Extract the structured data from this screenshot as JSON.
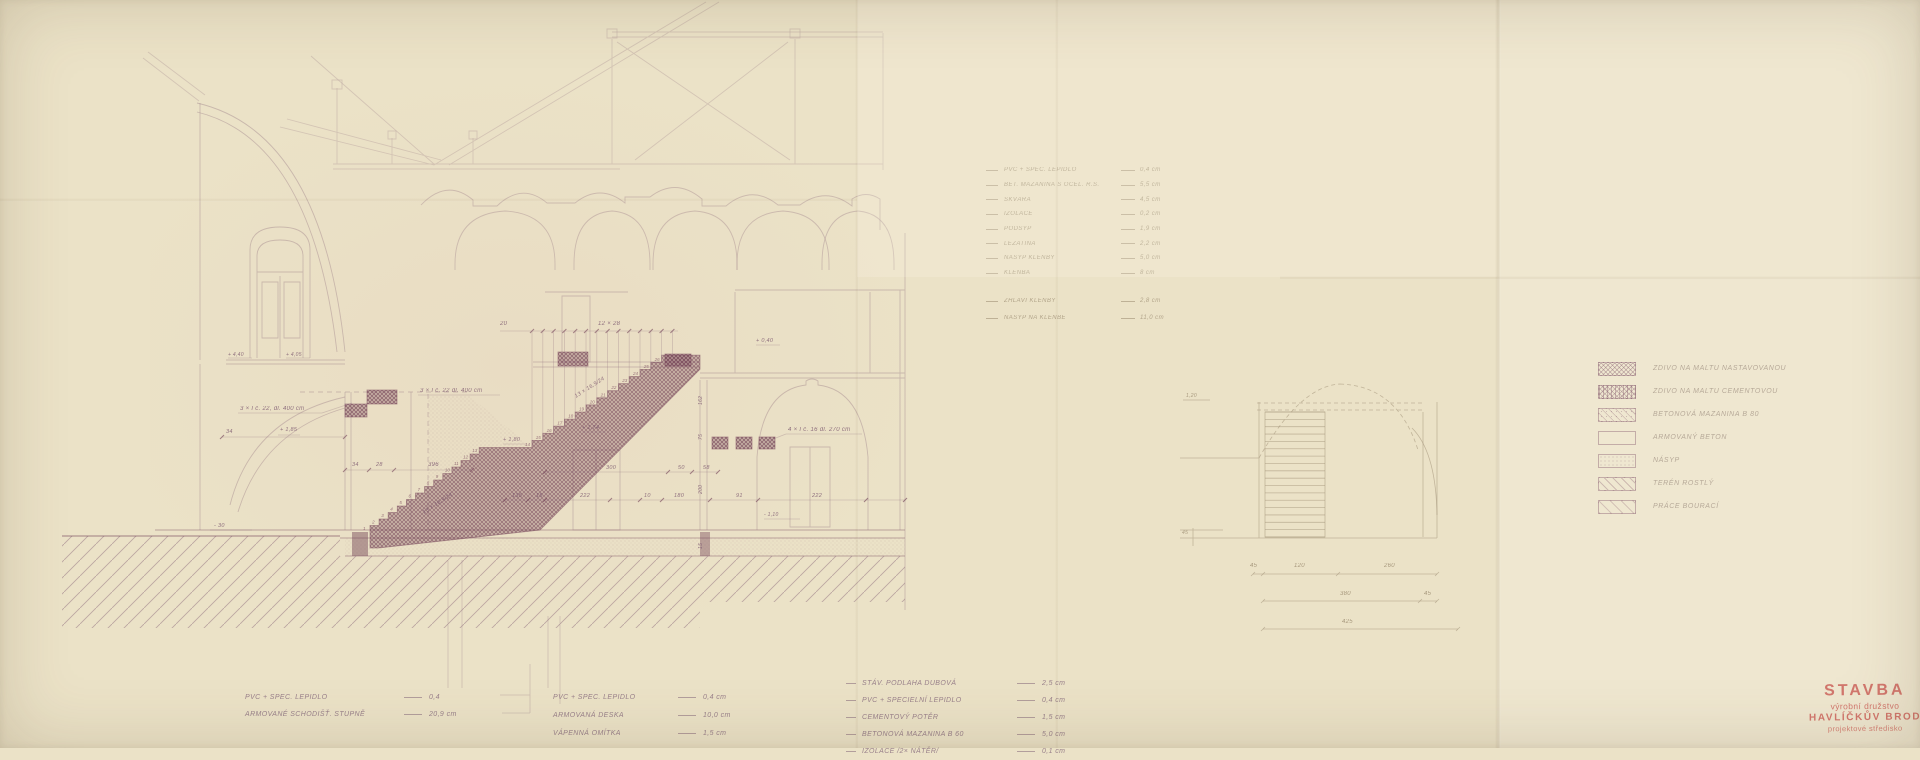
{
  "colors": {
    "paper": "#ebe2c7",
    "ink": "#8d6c7c",
    "ink_dark": "#6d3b52",
    "pencil": "#a5967c",
    "stamp_red": "#c3473e"
  },
  "stamp": {
    "line1": "STAVBA",
    "line2": "výrobní družstvo",
    "line3": "HAVLÍČKŮV BROD",
    "line4": "projektové středisko"
  },
  "legend": {
    "items": [
      {
        "pattern": "cross1",
        "label": "ZDIVO NA MALTU NASTAVOVANOU"
      },
      {
        "pattern": "cross2",
        "label": "ZDIVO NA MALTU CEMENTOVOU"
      },
      {
        "pattern": "diagdots",
        "label": "BETONOVÁ MAZANINA B 80"
      },
      {
        "pattern": "empty",
        "label": "ARMOVANÝ BETON"
      },
      {
        "pattern": "dots",
        "label": "NÁSYP"
      },
      {
        "pattern": "diag",
        "label": "TERÉN ROSTLÝ"
      },
      {
        "pattern": "diag2",
        "label": "PRÁCE BOURACÍ"
      }
    ]
  },
  "spec_list": {
    "rows": [
      {
        "label": "PVC + SPEC. LEPIDLO",
        "value": "0,4 cm"
      },
      {
        "label": "BET. MAZANINA S OCEL. R.Š.",
        "value": "5,5 cm"
      },
      {
        "label": "ŠKVÁRA",
        "value": "4,5 cm"
      },
      {
        "label": "IZOLACE",
        "value": "0,2 cm"
      },
      {
        "label": "PODSYP",
        "value": "1,9 cm"
      },
      {
        "label": "LEŽATINA",
        "value": "2,2 cm"
      },
      {
        "label": "NÁSYP KLENBY",
        "value": "5,0 cm"
      },
      {
        "label": "KLENBA",
        "value": "8 cm"
      }
    ],
    "rows_extra": [
      {
        "label": "ZHLAVÍ KLENBY",
        "value": "2,8 cm"
      },
      {
        "label": "NÁSYP NA KLENBĚ",
        "value": "11,0 cm"
      }
    ]
  },
  "notes_left": {
    "rows": [
      {
        "label": "PVC + SPEC. LEPIDLO",
        "value": "0,4"
      },
      {
        "label": "ARMOVANÉ SCHODIŠŤ. STUPNĚ",
        "value": "20,9 cm"
      }
    ]
  },
  "notes_mid": {
    "rows": [
      {
        "label": "PVC + SPEC. LEPIDLO",
        "value": "0,4 cm"
      },
      {
        "label": "ARMOVANÁ DESKA",
        "value": "10,0 cm"
      },
      {
        "label": "VÁPENNÁ OMÍTKA",
        "value": "1,5 cm"
      }
    ]
  },
  "notes_right": {
    "rows": [
      {
        "label": "STÁV. PODLAHA DUBOVÁ",
        "value": "2,5 cm"
      },
      {
        "label": "PVC + SPECIELNÍ LEPIDLO",
        "value": "0,4 cm"
      },
      {
        "label": "CEMENTOVÝ POTĚR",
        "value": "1,5 cm"
      },
      {
        "label": "BETONOVÁ MAZANINA B 60",
        "value": "5,0 cm"
      },
      {
        "label": "IZOLACE /2× NÁTĚR/",
        "value": "0,1 cm"
      }
    ]
  },
  "drawing": {
    "stairs": {
      "flights": [
        {
          "x": 370,
          "y": 532,
          "steps": 13,
          "tread": 9.1,
          "rise": 6.5
        },
        {
          "x": 532,
          "y": 448,
          "steps": 13,
          "tread": 10.8,
          "rise": 7.1
        }
      ],
      "top_x": 700,
      "soffit": 14
    },
    "arches": [
      [
        505,
        50
      ],
      [
        612,
        38
      ],
      [
        695,
        42
      ],
      [
        783,
        46
      ],
      [
        858,
        36
      ]
    ],
    "plan": {
      "x": 1265,
      "y": 412,
      "w": 60,
      "h": 125,
      "treads": 17
    },
    "annotations": [
      {
        "x": 240,
        "y": 410,
        "t": "3 × I č. 22, dl. 400 cm",
        "k": "ink",
        "s": 6
      },
      {
        "x": 420,
        "y": 392,
        "t": "3 × I č. 22 dl. 400 cm",
        "k": "ink",
        "s": 6
      },
      {
        "x": 788,
        "y": 431,
        "t": "4 × I č. 16 dl. 270 cm",
        "k": "ink",
        "s": 6
      },
      {
        "x": 598,
        "y": 325,
        "t": "12 × 28",
        "k": "ink",
        "s": 6
      },
      {
        "x": 500,
        "y": 325,
        "t": "20",
        "k": "ink",
        "s": 6
      },
      {
        "x": 428,
        "y": 466,
        "t": "396",
        "k": "ink",
        "s": 6
      },
      {
        "x": 352,
        "y": 466,
        "t": "34",
        "k": "ink",
        "s": 5.5
      },
      {
        "x": 376,
        "y": 466,
        "t": "28",
        "k": "ink",
        "s": 5.5
      },
      {
        "x": 226,
        "y": 433,
        "t": "34",
        "k": "ink",
        "s": 5.5
      },
      {
        "x": 280,
        "y": 431,
        "t": "+ 1,85",
        "k": "ink",
        "s": 5.5
      },
      {
        "x": 503,
        "y": 441,
        "t": "+ 1,80",
        "k": "ink",
        "s": 5.5
      },
      {
        "x": 582,
        "y": 429,
        "t": "+ 1,74",
        "k": "ink",
        "s": 5.5
      },
      {
        "x": 756,
        "y": 342,
        "t": "+ 0,40",
        "k": "ink",
        "s": 5.5
      },
      {
        "x": 214,
        "y": 527,
        "t": "- 30",
        "k": "ink",
        "s": 5.5
      },
      {
        "x": 228,
        "y": 356,
        "t": "+ 4,40",
        "k": "ink",
        "s": 5
      },
      {
        "x": 286,
        "y": 356,
        "t": "+ 4,05",
        "k": "ink",
        "s": 5
      },
      {
        "x": 764,
        "y": 516,
        "t": "- 1,10",
        "k": "ink",
        "s": 5
      },
      {
        "x": 512,
        "y": 497,
        "t": "135",
        "k": "ink",
        "s": 5.5
      },
      {
        "x": 536,
        "y": 497,
        "t": "15",
        "k": "ink",
        "s": 5.5
      },
      {
        "x": 580,
        "y": 497,
        "t": "222",
        "k": "ink",
        "s": 5.5
      },
      {
        "x": 644,
        "y": 497,
        "t": "10",
        "k": "ink",
        "s": 5.5
      },
      {
        "x": 674,
        "y": 497,
        "t": "180",
        "k": "ink",
        "s": 5.5
      },
      {
        "x": 736,
        "y": 497,
        "t": "91",
        "k": "ink",
        "s": 5.5
      },
      {
        "x": 812,
        "y": 497,
        "t": "222",
        "k": "ink",
        "s": 5.5
      },
      {
        "x": 606,
        "y": 469,
        "t": "300",
        "k": "ink",
        "s": 5.5
      },
      {
        "x": 678,
        "y": 469,
        "t": "50",
        "k": "ink",
        "s": 5.5
      },
      {
        "x": 703,
        "y": 469,
        "t": "58",
        "k": "ink",
        "s": 5.5
      },
      {
        "x": 702,
        "y": 405,
        "t": "162",
        "k": "ink",
        "s": 5,
        "r": -90
      },
      {
        "x": 702,
        "y": 440,
        "t": "75",
        "k": "ink",
        "s": 5,
        "r": -90
      },
      {
        "x": 702,
        "y": 494,
        "t": "200",
        "k": "ink",
        "s": 5,
        "r": -90
      },
      {
        "x": 702,
        "y": 549,
        "t": "15",
        "k": "ink",
        "s": 5,
        "r": -90
      },
      {
        "x": 424,
        "y": 514,
        "t": "13 × 16,9/24",
        "k": "ink",
        "s": 5.5,
        "r": -33
      },
      {
        "x": 576,
        "y": 398,
        "t": "13 × 16,9/24",
        "k": "ink",
        "s": 5.5,
        "r": -33
      },
      {
        "x": 1250,
        "y": 567,
        "t": "45",
        "k": "pencil",
        "s": 6
      },
      {
        "x": 1294,
        "y": 567,
        "t": "120",
        "k": "pencil",
        "s": 6
      },
      {
        "x": 1384,
        "y": 567,
        "t": "260",
        "k": "pencil",
        "s": 6
      },
      {
        "x": 1340,
        "y": 595,
        "t": "380",
        "k": "pencil",
        "s": 6
      },
      {
        "x": 1424,
        "y": 595,
        "t": "45",
        "k": "pencil",
        "s": 6
      },
      {
        "x": 1342,
        "y": 623,
        "t": "425",
        "k": "pencil",
        "s": 6
      },
      {
        "x": 1186,
        "y": 397,
        "t": "1,20",
        "k": "pencil",
        "s": 5
      },
      {
        "x": 1182,
        "y": 534,
        "t": "45",
        "k": "pencil",
        "s": 5
      }
    ]
  }
}
